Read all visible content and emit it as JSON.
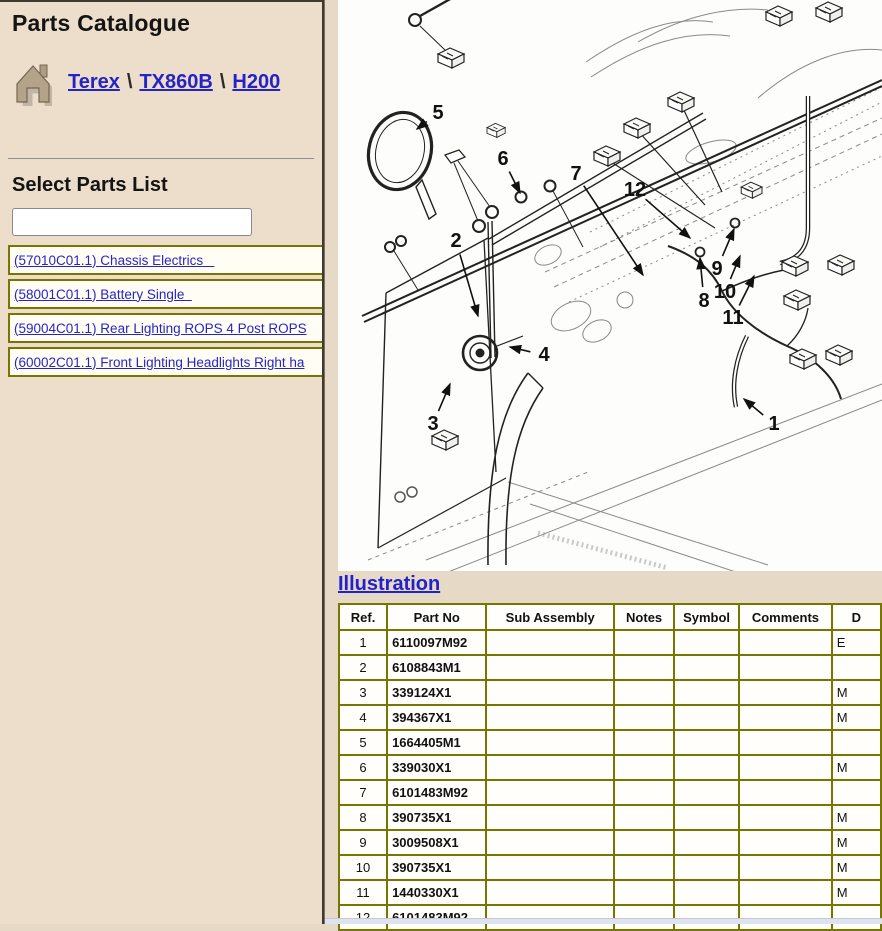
{
  "sidebar": {
    "title": "Parts Catalogue",
    "breadcrumb": {
      "separator": "\\",
      "items": [
        {
          "label": "Terex"
        },
        {
          "label": "TX860B"
        },
        {
          "label": "H200"
        }
      ]
    },
    "select_parts_heading": "Select Parts List",
    "filter_input": {
      "value": "",
      "placeholder": ""
    },
    "parts_links": [
      "(57010C01.1) Chassis Electrics   ",
      "(58001C01.1) Battery Single  ",
      "(59004C01.1) Rear Lighting ROPS 4 Post ROPS",
      "(60002C01.1) Front Lighting Headlights Right ha"
    ]
  },
  "main": {
    "illustration_link": "Illustration",
    "table": {
      "headers": [
        "Ref.",
        "Part No",
        "Sub Assembly",
        "Notes",
        "Symbol",
        "Comments",
        "D"
      ],
      "rows": [
        {
          "ref": "1",
          "part": "6110097M92",
          "sub": "",
          "notes": "",
          "symbol": "",
          "comments": "",
          "desc": "E"
        },
        {
          "ref": "2",
          "part": "6108843M1",
          "sub": "",
          "notes": "",
          "symbol": "",
          "comments": "",
          "desc": ""
        },
        {
          "ref": "3",
          "part": "339124X1",
          "sub": "",
          "notes": "",
          "symbol": "",
          "comments": "",
          "desc": "M"
        },
        {
          "ref": "4",
          "part": "394367X1",
          "sub": "",
          "notes": "",
          "symbol": "",
          "comments": "",
          "desc": "M"
        },
        {
          "ref": "5",
          "part": "1664405M1",
          "sub": "",
          "notes": "",
          "symbol": "",
          "comments": "",
          "desc": ""
        },
        {
          "ref": "6",
          "part": "339030X1",
          "sub": "",
          "notes": "",
          "symbol": "",
          "comments": "",
          "desc": "M"
        },
        {
          "ref": "7",
          "part": "6101483M92",
          "sub": "",
          "notes": "",
          "symbol": "",
          "comments": "",
          "desc": ""
        },
        {
          "ref": "8",
          "part": "390735X1",
          "sub": "",
          "notes": "",
          "symbol": "",
          "comments": "",
          "desc": "M"
        },
        {
          "ref": "9",
          "part": "3009508X1",
          "sub": "",
          "notes": "",
          "symbol": "",
          "comments": "",
          "desc": "M"
        },
        {
          "ref": "10",
          "part": "390735X1",
          "sub": "",
          "notes": "",
          "symbol": "",
          "comments": "",
          "desc": "M"
        },
        {
          "ref": "11",
          "part": "1440330X1",
          "sub": "",
          "notes": "",
          "symbol": "",
          "comments": "",
          "desc": "M"
        },
        {
          "ref": "12",
          "part": "6101483M92",
          "sub": "",
          "notes": "",
          "symbol": "",
          "comments": "",
          "desc": ""
        }
      ]
    },
    "diagram": {
      "callouts": [
        {
          "n": "1",
          "x": 436,
          "y": 424,
          "tx": 406,
          "ty": 399
        },
        {
          "n": "2",
          "x": 118,
          "y": 241,
          "tx": 140,
          "ty": 316
        },
        {
          "n": "3",
          "x": 95,
          "y": 424,
          "tx": 112,
          "ty": 384
        },
        {
          "n": "4",
          "x": 206,
          "y": 355,
          "tx": 172,
          "ty": 347
        },
        {
          "n": "5",
          "x": 100,
          "y": 113,
          "tx": 79,
          "ty": 129
        },
        {
          "n": "6",
          "x": 165,
          "y": 159,
          "tx": 182,
          "ty": 193
        },
        {
          "n": "7",
          "x": 238,
          "y": 174,
          "tx": 305,
          "ty": 275
        },
        {
          "n": "8",
          "x": 366,
          "y": 301,
          "tx": 362,
          "ty": 258
        },
        {
          "n": "9",
          "x": 379,
          "y": 269,
          "tx": 396,
          "ty": 229
        },
        {
          "n": "10",
          "x": 387,
          "y": 292,
          "tx": 402,
          "ty": 256
        },
        {
          "n": "11",
          "x": 395,
          "y": 318,
          "tx": 416,
          "ty": 276
        },
        {
          "n": "12",
          "x": 297,
          "y": 190,
          "tx": 352,
          "ty": 238
        }
      ]
    }
  },
  "colors": {
    "sidebar_bg": "#ecdeca",
    "main_bg": "#e6dac6",
    "table_border": "#767600",
    "link_blue": "#2323c8",
    "scrollbar": "#dde3ef"
  }
}
